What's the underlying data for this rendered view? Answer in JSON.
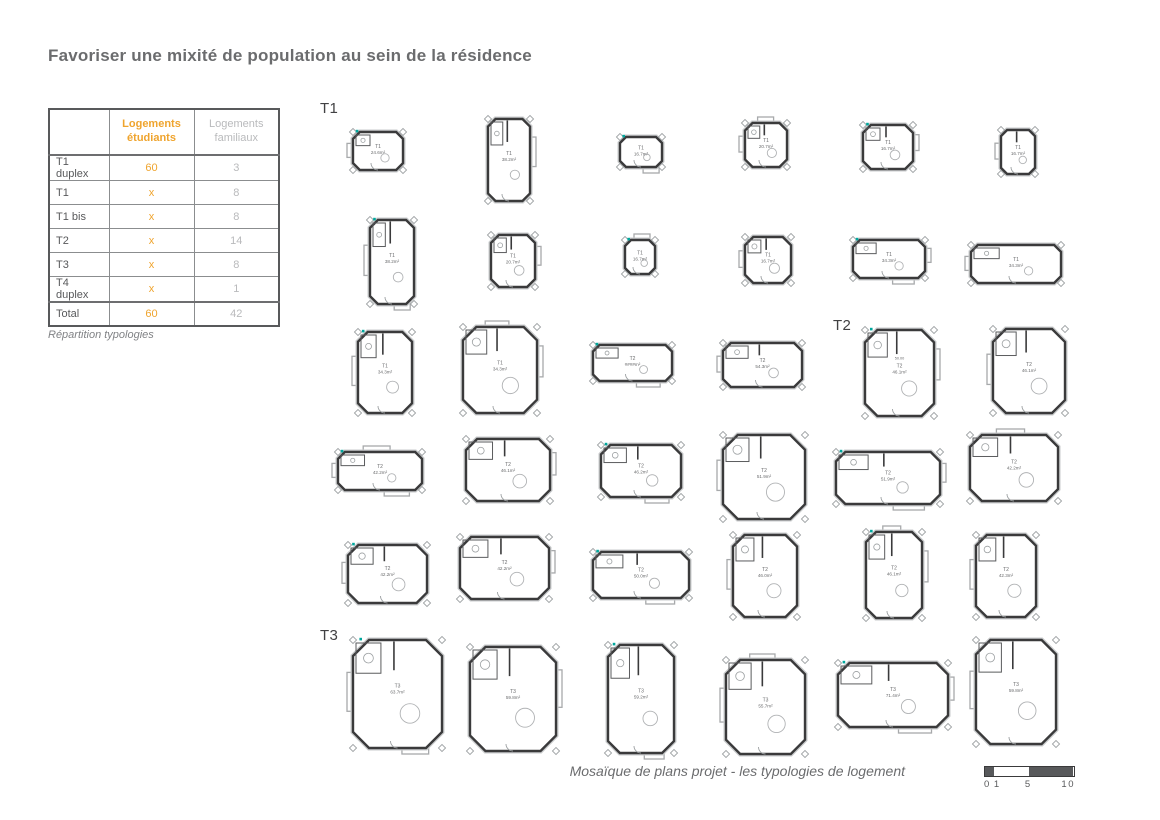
{
  "page": {
    "title": "Favoriser une mixité de population au sein de la résidence"
  },
  "table": {
    "caption": "Répartition typologies",
    "col_headers": [
      "Logements étudiants",
      "Logements familiaux"
    ],
    "rows": [
      {
        "label": "T1 duplex",
        "etudiants": "60",
        "familiaux": "3"
      },
      {
        "label": "T1",
        "etudiants": "x",
        "familiaux": "8"
      },
      {
        "label": "T1 bis",
        "etudiants": "x",
        "familiaux": "8"
      },
      {
        "label": "T2",
        "etudiants": "x",
        "familiaux": "14"
      },
      {
        "label": "T3",
        "etudiants": "x",
        "familiaux": "8"
      },
      {
        "label": "T4 duplex",
        "etudiants": "x",
        "familiaux": "1"
      },
      {
        "label": "Total",
        "etudiants": "60",
        "familiaux": "42"
      }
    ]
  },
  "sections": [
    {
      "label": "T1",
      "x": 320,
      "y": 100
    },
    {
      "label": "T2",
      "x": 833,
      "y": 317
    },
    {
      "label": "T3",
      "x": 320,
      "y": 627
    }
  ],
  "plans": [
    {
      "type": "T1",
      "area": "24.6m²",
      "x": 345,
      "y": 125,
      "w": 66,
      "h": 52
    },
    {
      "type": "T1",
      "area": "38.2m²",
      "x": 480,
      "y": 112,
      "w": 58,
      "h": 96
    },
    {
      "type": "T1",
      "area": "16.7m²",
      "x": 612,
      "y": 130,
      "w": 58,
      "h": 44
    },
    {
      "type": "T1",
      "area": "20.7m²",
      "x": 737,
      "y": 116,
      "w": 58,
      "h": 58
    },
    {
      "type": "T1",
      "area": "16.7m²",
      "x": 855,
      "y": 118,
      "w": 66,
      "h": 58
    },
    {
      "type": "T1",
      "area": "16.7m²",
      "x": 993,
      "y": 123,
      "w": 50,
      "h": 58
    },
    {
      "type": "T1",
      "area": "38.2m²",
      "x": 362,
      "y": 213,
      "w": 60,
      "h": 98
    },
    {
      "type": "T1",
      "area": "20.7m²",
      "x": 483,
      "y": 228,
      "w": 60,
      "h": 66
    },
    {
      "type": "T1",
      "area": "16.7m²",
      "x": 617,
      "y": 233,
      "w": 46,
      "h": 48
    },
    {
      "type": "T1",
      "area": "16.7m²",
      "x": 737,
      "y": 230,
      "w": 62,
      "h": 60
    },
    {
      "type": "T1",
      "area": "34.3m²",
      "x": 845,
      "y": 233,
      "w": 88,
      "h": 52
    },
    {
      "type": "T1",
      "area": "34.3m²",
      "x": 963,
      "y": 238,
      "w": 106,
      "h": 52
    },
    {
      "type": "T1",
      "area": "34.3m²",
      "x": 350,
      "y": 325,
      "w": 70,
      "h": 95
    },
    {
      "type": "T1",
      "area": "34.3m²",
      "x": 455,
      "y": 320,
      "w": 90,
      "h": 100
    },
    {
      "type": "T2",
      "area": "####m²",
      "x": 585,
      "y": 338,
      "w": 95,
      "h": 50
    },
    {
      "type": "T2",
      "area": "54.3m²",
      "x": 715,
      "y": 336,
      "w": 95,
      "h": 58
    },
    {
      "type": "T2",
      "area": "46.1m²",
      "x": 857,
      "y": 323,
      "w": 85,
      "h": 100,
      "extra": "50.00"
    },
    {
      "type": "T2",
      "area": "46.1m²",
      "x": 985,
      "y": 322,
      "w": 88,
      "h": 98
    },
    {
      "type": "T2",
      "area": "42.2m²",
      "x": 330,
      "y": 445,
      "w": 100,
      "h": 52
    },
    {
      "type": "T2",
      "area": "46.1m²",
      "x": 458,
      "y": 432,
      "w": 100,
      "h": 76
    },
    {
      "type": "T2",
      "area": "46.2m²",
      "x": 593,
      "y": 438,
      "w": 96,
      "h": 66
    },
    {
      "type": "T2",
      "area": "51.9m²",
      "x": 715,
      "y": 428,
      "w": 98,
      "h": 98
    },
    {
      "type": "T2",
      "area": "51.9m²",
      "x": 828,
      "y": 445,
      "w": 120,
      "h": 66
    },
    {
      "type": "T2",
      "area": "42.2m²",
      "x": 962,
      "y": 428,
      "w": 104,
      "h": 80
    },
    {
      "type": "T2",
      "area": "42.2m²",
      "x": 340,
      "y": 538,
      "w": 95,
      "h": 72
    },
    {
      "type": "T2",
      "area": "42.2m²",
      "x": 452,
      "y": 530,
      "w": 105,
      "h": 76
    },
    {
      "type": "T2",
      "area": "50.0m²",
      "x": 585,
      "y": 545,
      "w": 112,
      "h": 60
    },
    {
      "type": "T2",
      "area": "46.0m²",
      "x": 725,
      "y": 528,
      "w": 80,
      "h": 96
    },
    {
      "type": "T2",
      "area": "46.1m²",
      "x": 858,
      "y": 525,
      "w": 72,
      "h": 100
    },
    {
      "type": "T2",
      "area": "42.3m²",
      "x": 968,
      "y": 528,
      "w": 76,
      "h": 96
    },
    {
      "type": "T3",
      "area": "63.7m²",
      "x": 345,
      "y": 633,
      "w": 105,
      "h": 122
    },
    {
      "type": "T3",
      "area": "59.8m²",
      "x": 462,
      "y": 640,
      "w": 102,
      "h": 118
    },
    {
      "type": "T3",
      "area": "59.2m²",
      "x": 600,
      "y": 638,
      "w": 82,
      "h": 122
    },
    {
      "type": "T3",
      "area": "55.7m²",
      "x": 718,
      "y": 653,
      "w": 95,
      "h": 108
    },
    {
      "type": "T3",
      "area": "71.4m²",
      "x": 830,
      "y": 656,
      "w": 126,
      "h": 78
    },
    {
      "type": "T3",
      "area": "59.8m²",
      "x": 968,
      "y": 633,
      "w": 96,
      "h": 118
    }
  ],
  "footer": {
    "caption": "Mosaïque de plans projet -  les typologies de logement",
    "scale": {
      "unit_px": 8.8,
      "segments": [
        {
          "from": 0,
          "to": 1,
          "dark": true
        },
        {
          "from": 1,
          "to": 5,
          "dark": false
        },
        {
          "from": 5,
          "to": 10,
          "dark": true
        }
      ],
      "labels": {
        "left": "0 1",
        "middle": "5",
        "right": "10"
      }
    }
  },
  "colors": {
    "accent_orange": "#efa42e",
    "muted_gray": "#b9babc",
    "text_gray": "#58595b",
    "title_gray": "#6b6c6e",
    "wall_dark": "#3a3a3b",
    "annex_gray": "#a7a9ab",
    "entry_teal": "#00a79d"
  }
}
